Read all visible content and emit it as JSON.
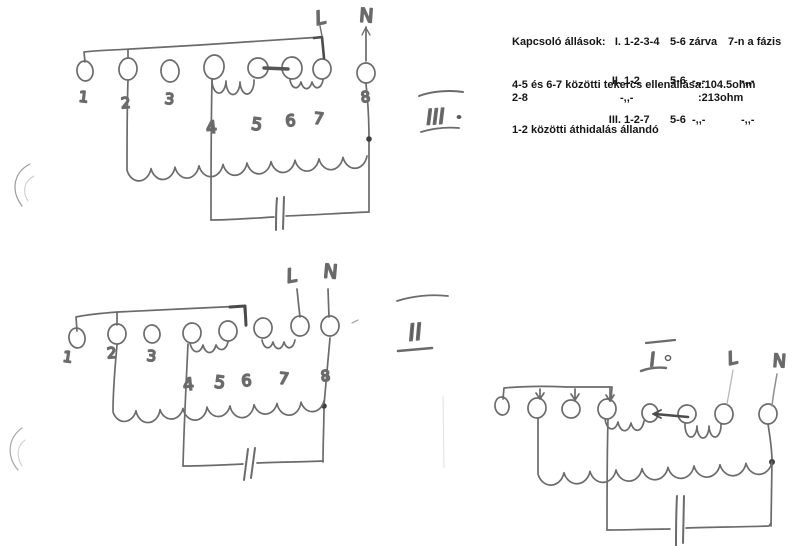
{
  "typed_notes": {
    "switch": {
      "heading": "Kapcsoló állások:",
      "rows": [
        {
          "position": "I.",
          "contacts": "1-2-3-4",
          "closed": "5-6 zárva",
          "phase": "7-n a fázis"
        },
        {
          "position": "II.",
          "contacts": "1-2",
          "closed": "5-6  -,,-",
          "phase": "-,,-"
        },
        {
          "position": "III.",
          "contacts": "1-2-7",
          "closed": "5-6  -,,-",
          "phase": "-,,-"
        }
      ]
    },
    "resistance": {
      "line1_label": "4-5 és 6-7 közötti tekercs ellenállása:",
      "line1_value": "104.5ohm",
      "line2_label": "2-8",
      "line2_ditto": "-,,-",
      "line2_value": ":213ohm"
    },
    "bridge_note": "1-2 közötti áthidalás állandó"
  },
  "diagrams": {
    "third": {
      "label": "III",
      "phase": "L",
      "neutral": "N",
      "terminals": [
        "1",
        "2",
        "3",
        "4",
        "5",
        "6",
        "7",
        "8"
      ]
    },
    "second": {
      "label": "II",
      "phase": "L",
      "neutral": "N",
      "terminals": [
        "1",
        "2",
        "3",
        "4",
        "5",
        "6",
        "7",
        "8"
      ]
    },
    "first": {
      "label": "I",
      "phase": "L",
      "neutral": "N"
    }
  },
  "colors": {
    "pencil": "#6b6b6b",
    "pencil_dark": "#4a4a4a",
    "printed_text": "#151515"
  }
}
